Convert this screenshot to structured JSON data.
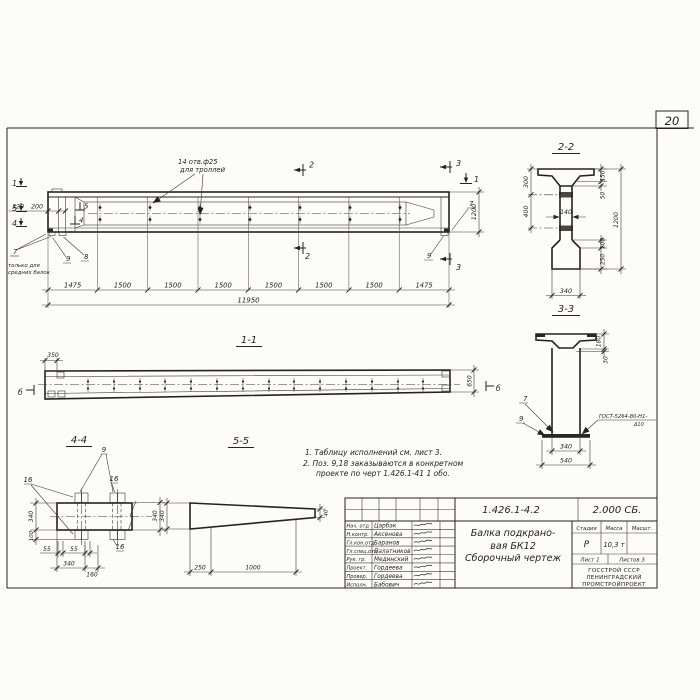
{
  "sheet": {
    "number": "20"
  },
  "elevation": {
    "holes_note_line1": "14 отв.ф25",
    "holes_note_line2": "для троллей",
    "left_note_line1": "только для",
    "left_note_line2": "средних балок",
    "dim_segments": [
      "1475",
      "1500",
      "1500",
      "1500",
      "1500",
      "1500",
      "1500",
      "1475"
    ],
    "dim_total": "11950",
    "dim_height": "1200",
    "dim_320": "320",
    "dim_200": "200",
    "marker_1": "1",
    "marker_2": "2",
    "marker_3": "3",
    "marker_4": "4",
    "marker_5": "5",
    "callout_7": "7",
    "callout_8": "8",
    "callout_9": "9"
  },
  "section22": {
    "title": "2-2",
    "dim_300": "300",
    "dim_400": "400",
    "dim_150": "150",
    "dim_50": "50",
    "dim_140": "140",
    "dim_1200": "1200",
    "dim_100": "100",
    "dim_250": "250",
    "dim_340": "340"
  },
  "section33": {
    "title": "3-3",
    "dim_180": "180",
    "dim_30": "30",
    "dim_340": "340",
    "dim_540": "540",
    "callout_7": "7",
    "callout_9": "9",
    "weld_note_line1": "ГОСТ-5264-80-Н1-",
    "weld_note_line2": "Δ10"
  },
  "section11": {
    "title": "1-1",
    "dim_350": "350",
    "dim_650": "650",
    "marker_b": "б"
  },
  "section44": {
    "title": "4-4",
    "dim_340_left": "340",
    "dim_100": "100",
    "dim_55a": "55",
    "dim_55b": "55",
    "dim_340_bottom": "340",
    "dim_160": "160",
    "dim_340_right": "340",
    "callout_9": "9",
    "callout_16": "16"
  },
  "section55": {
    "title": "5-5",
    "dim_340": "340",
    "dim_40": "40",
    "dim_250": "250",
    "dim_1000": "1000"
  },
  "notes": {
    "line1": "1. Таблицу исполнений см. лист 3.",
    "line2": "2. Поз. 9,18 заказываются в конкретном",
    "line3": "проекте по черт 1.426.1-41 1 обо."
  },
  "title_block": {
    "doc_number": "1.426.1-4.2",
    "doc_code": "2.000 СБ.",
    "rows": [
      {
        "label": "Нач. отд",
        "name": "Царбак"
      },
      {
        "label": "Н.контр.",
        "name": "Аксенова"
      },
      {
        "label": "Гл.кон.отд",
        "name": "Баранов"
      },
      {
        "label": "Гл.спец.отд",
        "name": "Палатников"
      },
      {
        "label": "Рук. гр.",
        "name": "Мединский"
      },
      {
        "label": "Проект.",
        "name": "Гордеева"
      },
      {
        "label": "Провер.",
        "name": "Гордеева"
      },
      {
        "label": "Исполн.",
        "name": "Бабович"
      }
    ],
    "title_line1": "Балка подкрано-",
    "title_line2": "вая БК12",
    "title_line3": "Сборочный чертеж",
    "stage_header": "Стадия",
    "mass_header": "Масса",
    "scale_header": "Масшт.",
    "stage_value": "Р",
    "mass_value": "10,3 т",
    "sheet_label": "Лист 1",
    "sheets_label": "Листов 3",
    "org_line1": "ГОССТРОЙ СССР",
    "org_line2": "ЛЕНИНГРАДСКИЙ",
    "org_line3": "ПРОМСТРОЙПРОЕКТ"
  }
}
